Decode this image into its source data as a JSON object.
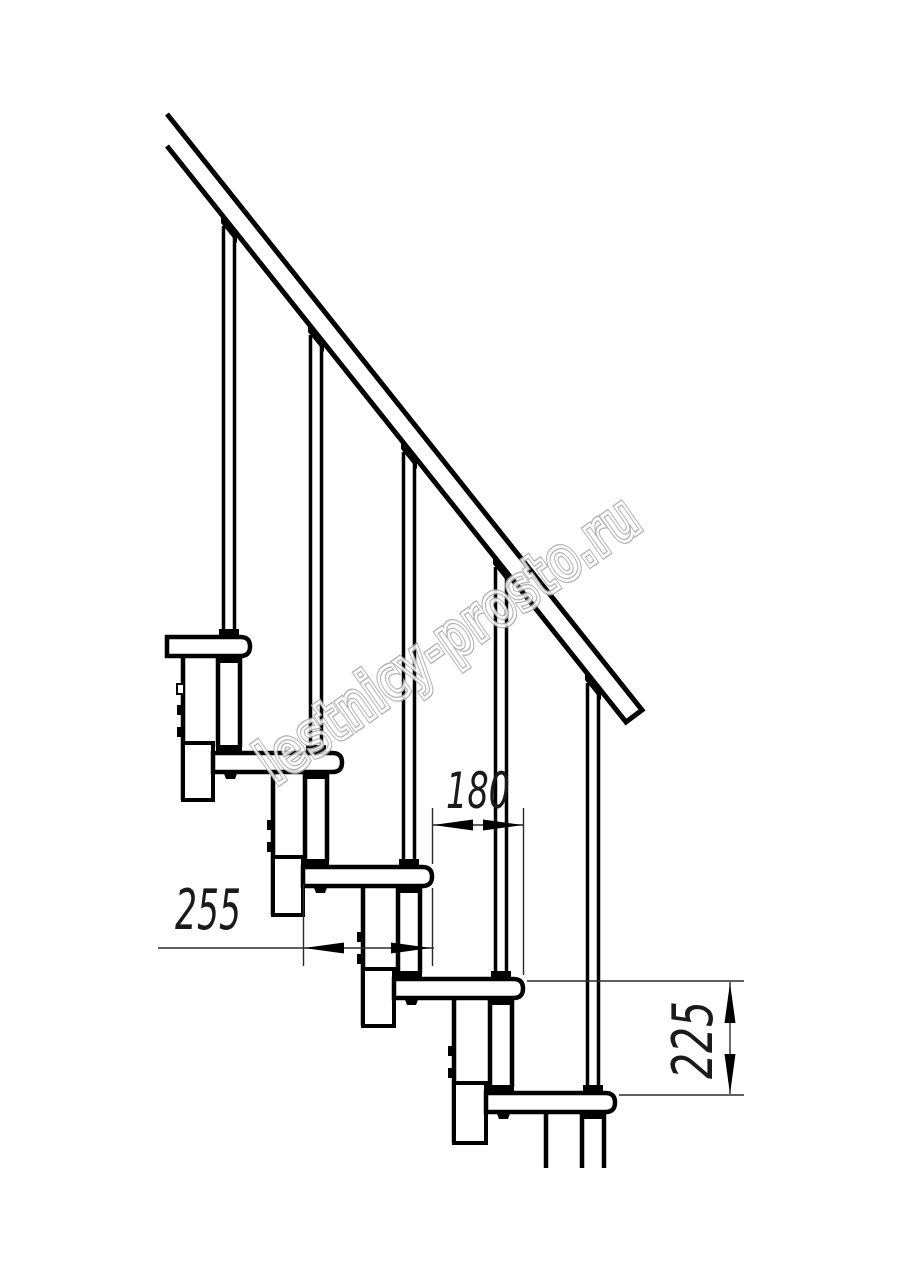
{
  "drawing": {
    "type_label": "staircase-side-view-technical-drawing",
    "dimensions": {
      "tread_depth": "255",
      "step_run": "180",
      "step_rise": "225"
    },
    "watermark": {
      "text": "lestnicy-prosto.ru",
      "color": "#a6a6a6"
    },
    "colors": {
      "line": "#000000",
      "dim_line": "#2b2b2b",
      "background": "#ffffff"
    }
  }
}
